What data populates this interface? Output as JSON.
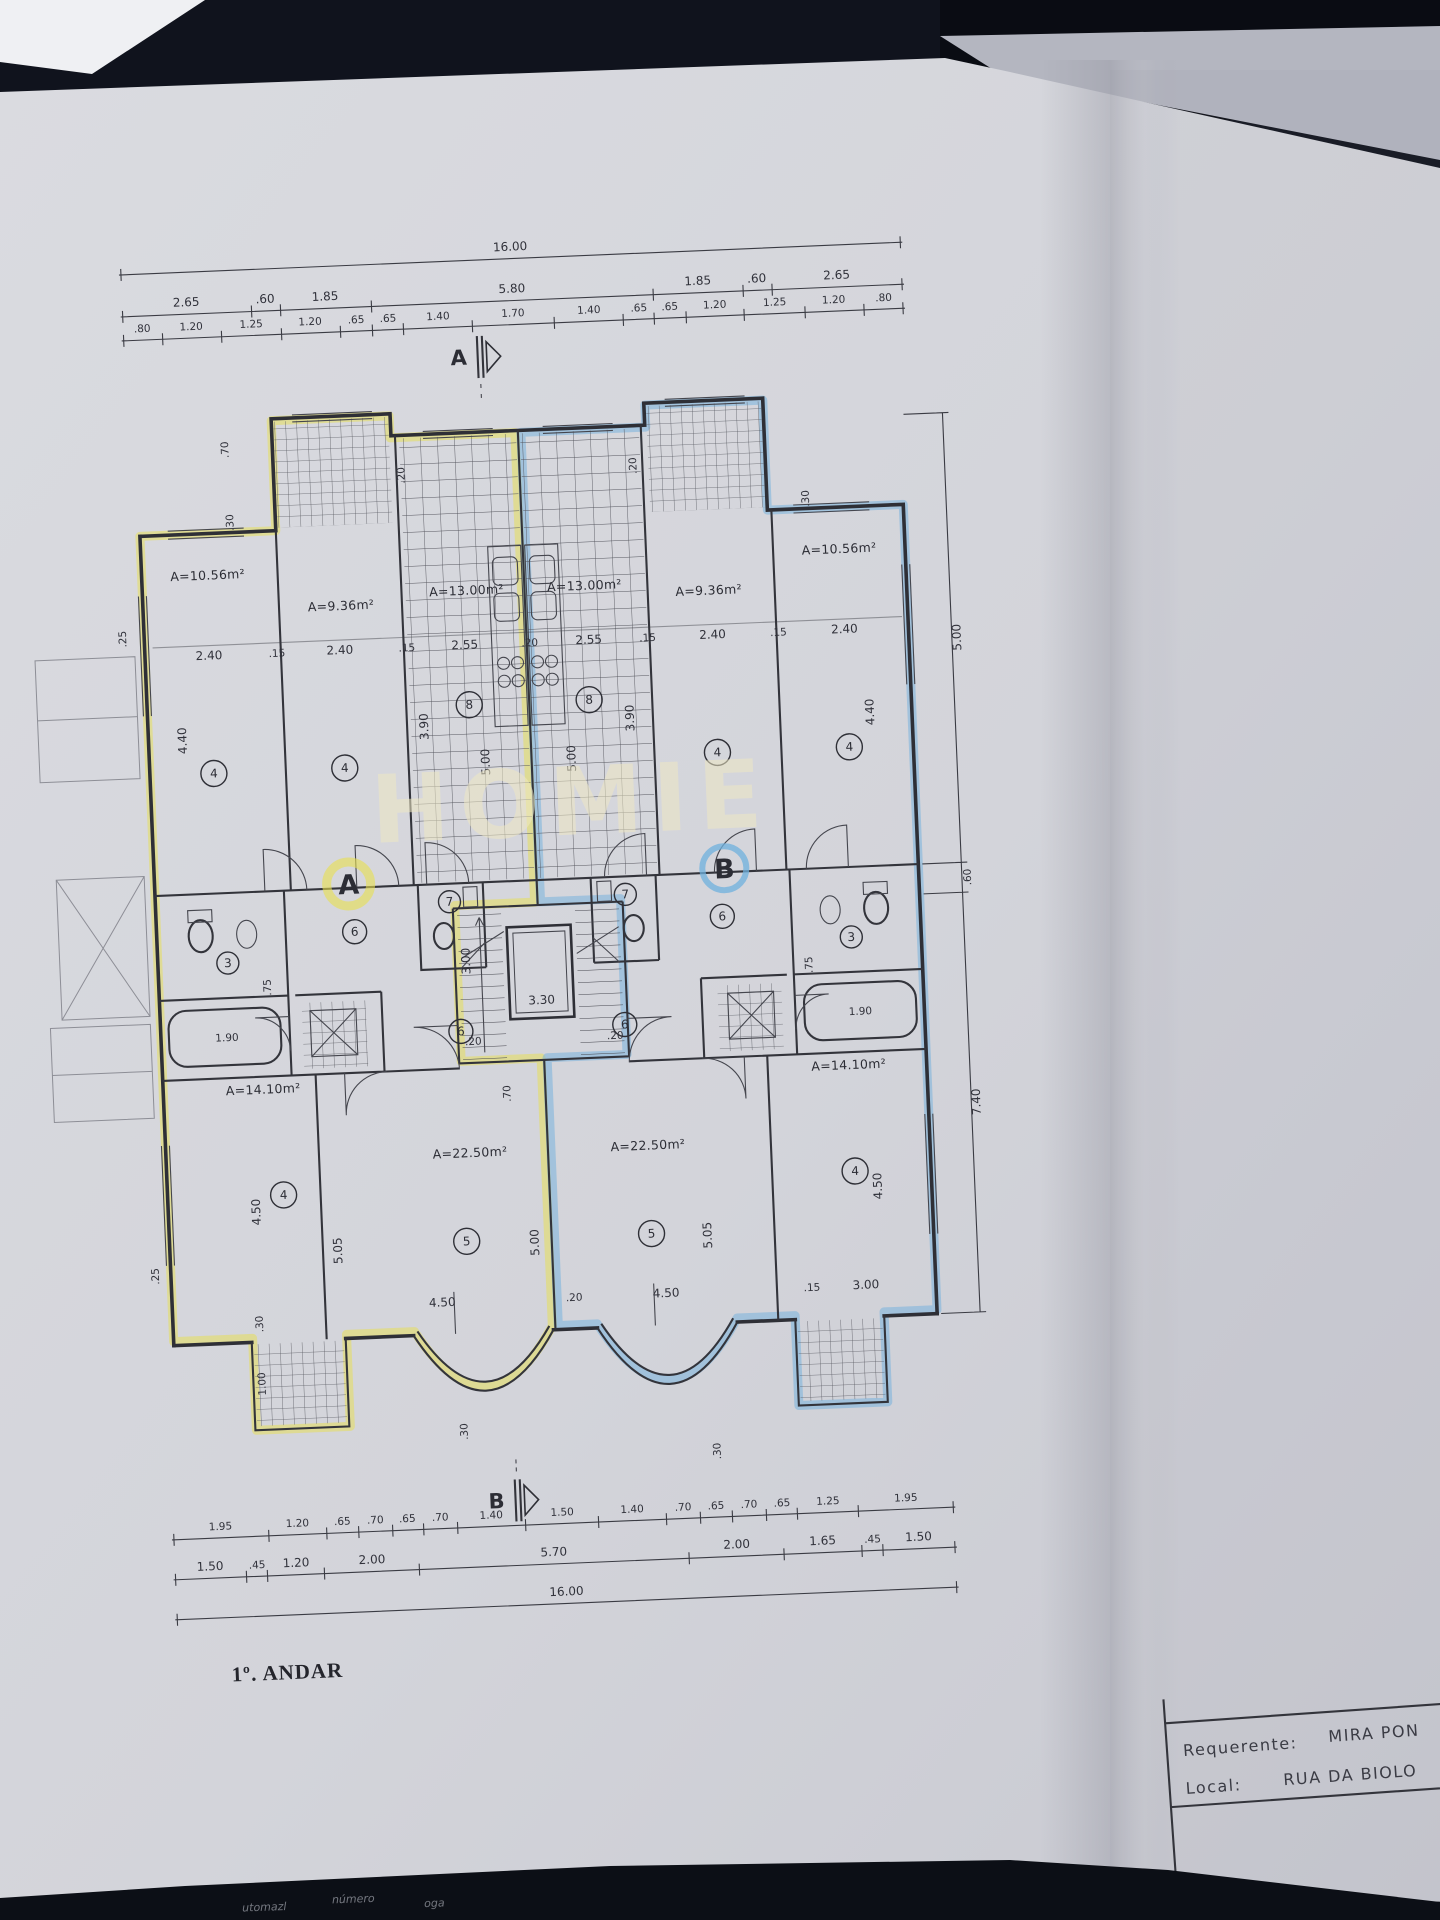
{
  "scene": {
    "background_color": "#10131d",
    "paper_color": "#d5d6dc",
    "ink_color": "#2e2f36",
    "apartment_a_highlight": "#e7e04e",
    "apartment_b_highlight": "#6fb0dd"
  },
  "watermark": "HOMIE",
  "floor_label": "1º. ANDAR",
  "section_markers": {
    "top": "A",
    "bottom": "B"
  },
  "apartment_markers": {
    "a": "A",
    "b": "B"
  },
  "title_block": {
    "requerente_label": "Requerente:",
    "requerente_value": "MIRA PON",
    "local_label": "Local:",
    "local_value": "RUA DA BIOLO"
  },
  "bottom_edge_fragments": [
    "utomazl",
    "número",
    "oga"
  ],
  "dims": {
    "top_total": "16.00",
    "top_row2": [
      "2.65",
      ".60",
      "1.85",
      "5.80",
      "1.85",
      ".60",
      "2.65"
    ],
    "top_row3": [
      ".80",
      "1.20",
      "1.25",
      "1.20",
      ".65",
      ".65",
      "1.40",
      "1.70",
      "1.40",
      ".65",
      ".65",
      "1.20",
      "1.25",
      "1.20",
      ".80"
    ],
    "bottom_row1": [
      "1.95",
      "1.20",
      ".65",
      ".70",
      ".65",
      ".70",
      "1.40",
      "1.50",
      "1.40",
      ".70",
      ".65",
      ".70",
      ".65",
      "1.25",
      "1.95"
    ],
    "bottom_row2": [
      "1.50",
      ".45",
      "1.20",
      "2.00",
      "5.70",
      "2.00",
      "1.65",
      ".45",
      "1.50"
    ],
    "bottom_total": "16.00",
    "right_side": [
      "5.00",
      ".60",
      "7.40"
    ],
    "left_side": [
      ".25",
      ".25"
    ]
  },
  "areas": [
    "A=10.56m²",
    "A=9.36m²",
    "A=13.00m²",
    "A=13.00m²",
    "A=9.36m²",
    "A=10.56m²",
    "A=14.10m²",
    "A=22.50m²",
    "A=22.50m²",
    "A=14.10m²"
  ],
  "room_numbers": [
    "4",
    "4",
    "8",
    "8",
    "4",
    "4",
    "7",
    "3",
    "6",
    "6",
    "7",
    "3",
    "6",
    "6",
    "5",
    "5",
    "4",
    "4"
  ],
  "plan_dims": [
    "2.40",
    ".15",
    "2.40",
    ".15",
    "2.55",
    ".20",
    "2.55",
    ".15",
    "2.40",
    ".15",
    "2.40",
    "4.40",
    "3.90",
    "5.00",
    "5.00",
    "3.90",
    "4.40",
    ".70",
    ".30",
    ".20",
    ".20",
    ".30",
    "1.90",
    ".75",
    "3.30",
    "3.00",
    ".20",
    ".20",
    "1.90",
    ".75",
    "4.50",
    "5.05",
    "5.00",
    "4.50",
    ".20",
    "4.50",
    "5.05",
    "4.50",
    ".15",
    "3.00",
    ".30",
    "1.00",
    ".30",
    ".30",
    ".70"
  ]
}
